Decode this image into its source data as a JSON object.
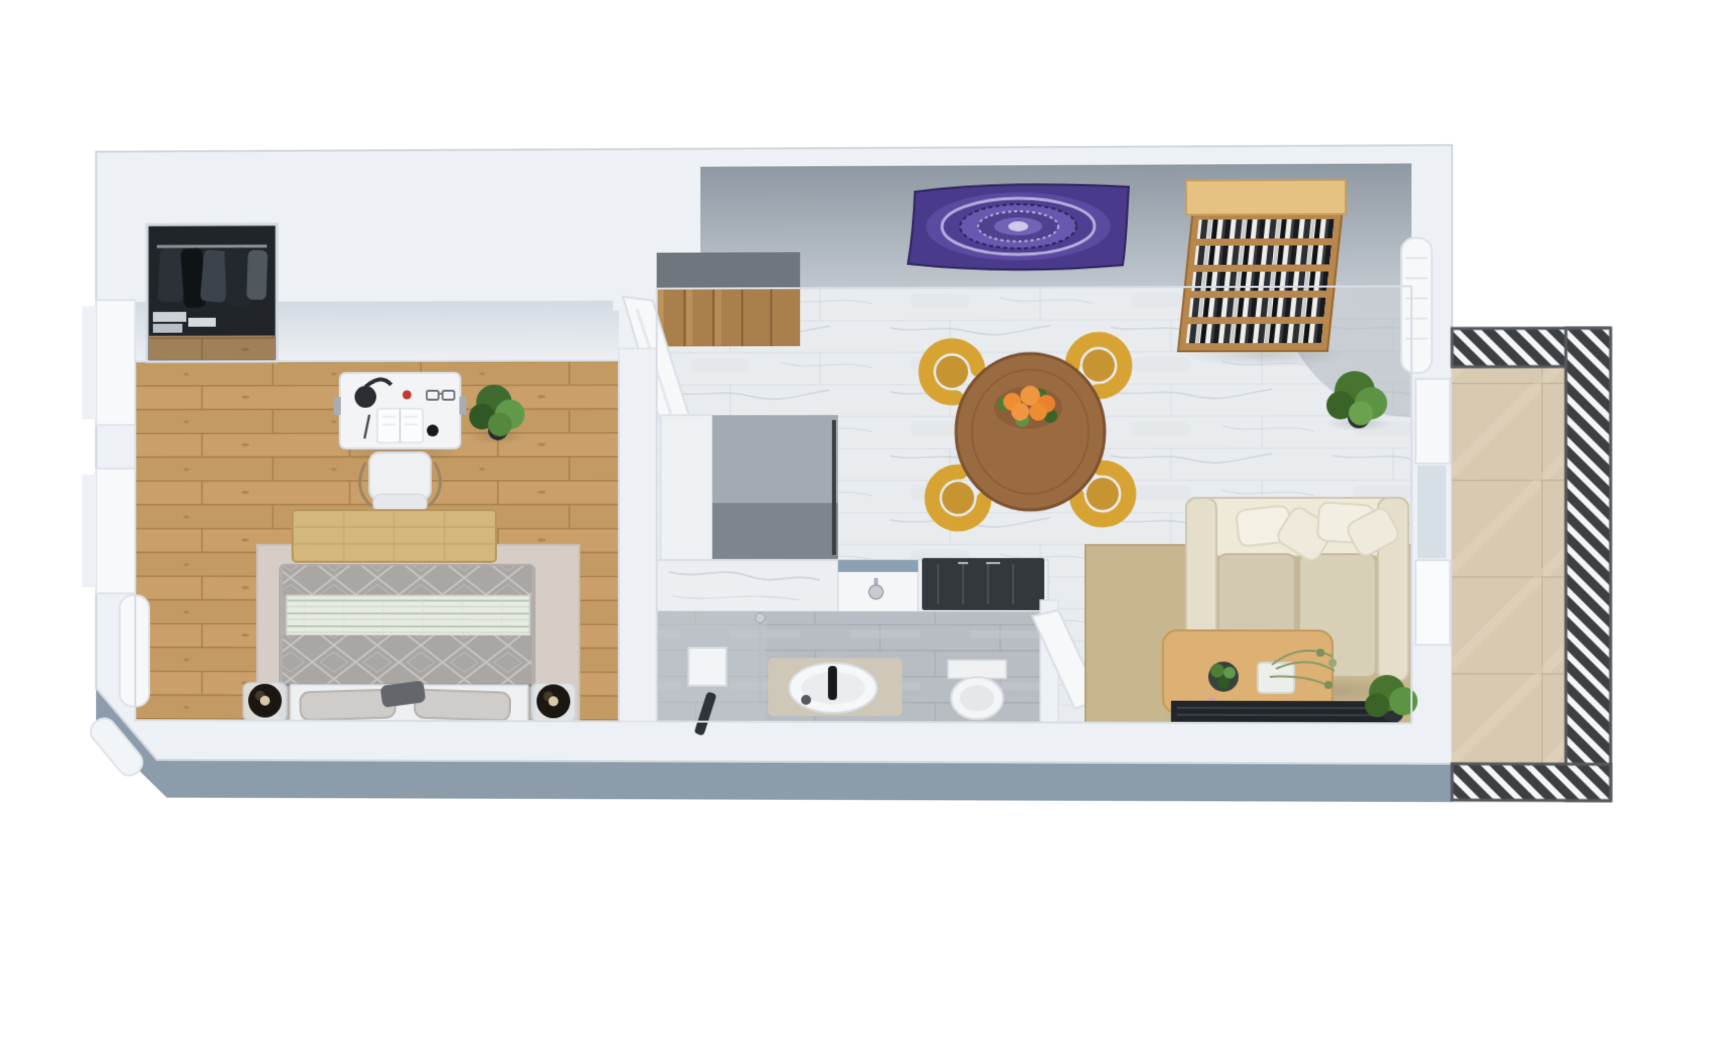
{
  "meta": {
    "type": "3d-apartment-floor-plan-render",
    "view": "top-down",
    "background": "#ffffff",
    "canvas_width": 1715,
    "canvas_height": 1054
  },
  "palette": {
    "wall": "#edf0f4",
    "wall_edge": "#d3dae2",
    "wall_shade": "#d7dde5",
    "upper_wall_gray": "#a6afb8",
    "exterior_base": "#8c9cab",
    "wood_base": "#c49a63",
    "wood_line": "#a87d49",
    "wood_light": "#d2a974",
    "wood_dark": "#8f6a3e",
    "marble_base": "#e9ecef",
    "marble_vein": "#c9d0d6",
    "marble_joint": "#dde2e6",
    "bath_tile": "#b7bdc3",
    "bath_tile_line": "#a6acb2",
    "stone_tile": "#d8cab1",
    "stone_line": "#c3b295",
    "slat_dark": "#3d4043",
    "slat_light": "#f4f6f8",
    "closet_interior": "#21252a",
    "stair_wood": "#a97f4c",
    "stair_shadow": "#6f767e",
    "fridge_top": "#a3aab1",
    "fridge_front": "#7e858d",
    "cabinet_white": "#eef1f4",
    "counter": "#eceef1",
    "sink_trim": "#8da0b3",
    "cooktop": "#33383d",
    "tapestry_purple": "#4a3a8c",
    "tapestry_dark": "#2e2357",
    "tapestry_light": "#b7abdb",
    "bookshelf_wood": "#b8874e",
    "bookshelf_top": "#e6c282",
    "table_wood": "#9a6a40",
    "table_rim": "#7c5230",
    "orange_fruit": "#ee8c31",
    "leaf_green": "#4e7d36",
    "chair_yellow": "#d7a434",
    "chair_seat": "#c79432",
    "sofa_base": "#e5decb",
    "sofa_cushion": "#efe9da",
    "sofa_seat": "#d3c9b0",
    "rug_tan": "#c8b68e",
    "coffee_table": "#dcb173",
    "tv_bench": "#22262b",
    "bed_rug": "#d6cdc6",
    "bench_tan": "#d3b77c",
    "quilt_gray": "#a9a6a3",
    "quilt_line": "#c6c3c0",
    "stripe_blanket": "#e7ebe4",
    "stripe_line": "#b9c9b3",
    "sheet_white": "#eef0f2",
    "pillow_gray": "#cfccc9",
    "lamp_dark": "#1b1612",
    "lamp_brass": "#d9c9a8",
    "desk_white": "#f2f4f6",
    "door_white": "#f6f8fa",
    "radiator_white": "#f6f8fa"
  },
  "scene": {
    "rooms": [
      {
        "name": "bedroom",
        "floor": "oak-wood",
        "objects": [
          "wardrobe-with-clothes",
          "desk",
          "desk-lamp",
          "open-book",
          "desk-chair",
          "potted-plant",
          "double-bed",
          "foot-bench",
          "area-rug",
          "bedside-lamp-left",
          "bedside-lamp-right",
          "wall-radiator",
          "window",
          "window"
        ]
      },
      {
        "name": "hallway",
        "objects": [
          "staircase",
          "open-door"
        ]
      },
      {
        "name": "kitchen",
        "objects": [
          "tall-cabinet",
          "refrigerator",
          "marble-counter",
          "sink",
          "cooktop"
        ]
      },
      {
        "name": "bathroom",
        "floor": "gray-tile",
        "objects": [
          "shower",
          "shower-control",
          "vanity-basin",
          "toilet",
          "open-door"
        ]
      },
      {
        "name": "living-dining",
        "floor": "marble-tile",
        "objects": [
          "mandala-tapestry",
          "bookshelf",
          "round-dining-table",
          "fruit-bowl",
          "dining-chair",
          "dining-chair",
          "dining-chair",
          "dining-chair",
          "sofa",
          "pillows",
          "area-rug",
          "coffee-table",
          "coffee-table-plants",
          "tv-bench",
          "potted-plant",
          "potted-plant",
          "wall-radiator"
        ]
      },
      {
        "name": "balcony",
        "floor": "stone-tile",
        "objects": [
          "slatted-railing",
          "balcony-doors"
        ]
      }
    ]
  }
}
